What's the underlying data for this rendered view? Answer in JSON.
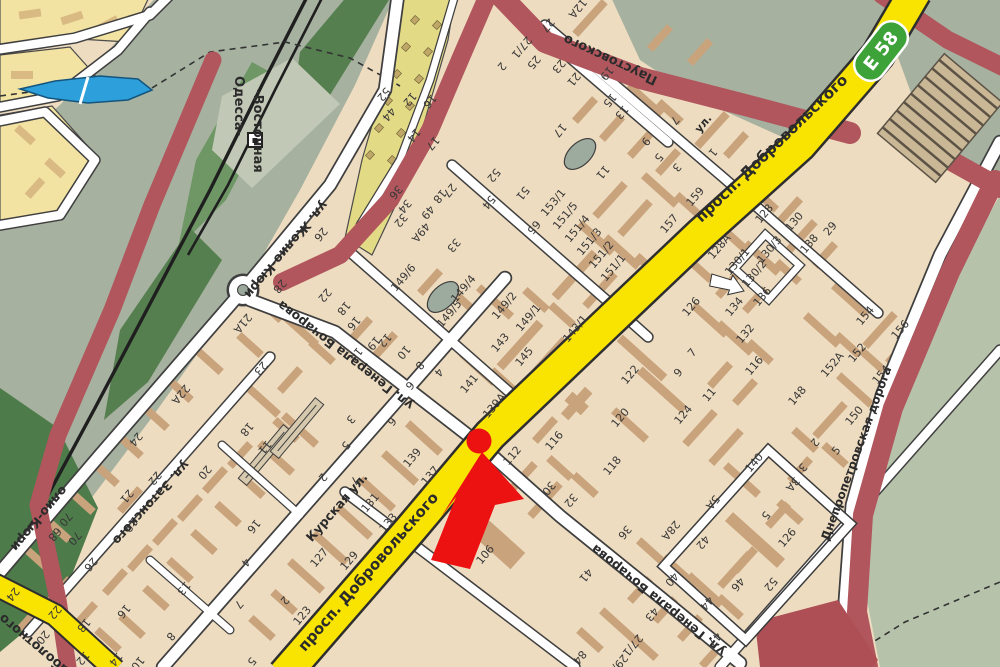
{
  "map": {
    "kind": "city-street-map",
    "highway_badge": {
      "code": "Е 58",
      "color": "#3da338"
    },
    "marker": {
      "shape": "red-arrow-with-dot",
      "color": "#ec1212"
    },
    "colors": {
      "block_fill": "#eedcc0",
      "building": "#c8a37c",
      "avenue": "#f9e300",
      "major_road": "#b0565c",
      "greenery": "#a6b1a0",
      "water": "#2d9fdb"
    },
    "street_labels": [
      {
        "t": "просп. Добровольского",
        "x": 775,
        "y": 152,
        "r": -44,
        "s": 15
      },
      {
        "t": "просп. Добровольского",
        "x": 372,
        "y": 575,
        "r": -49,
        "s": 15
      },
      {
        "t": "Курская ул.",
        "x": 340,
        "y": 510,
        "r": -49,
        "s": 12.5
      },
      {
        "t": "ул. Генерала Бочарова",
        "x": 348,
        "y": 352,
        "r": 218,
        "s": 12.5
      },
      {
        "t": "ул. Генерала Бочарова",
        "x": 661,
        "y": 597,
        "r": 219,
        "s": 12.5
      },
      {
        "t": "ул. Жолио-Кюри",
        "x": 283,
        "y": 247,
        "r": 130,
        "s": 12.5
      },
      {
        "t": "олио-Кюри",
        "x": 36,
        "y": 516,
        "r": 130,
        "s": 12.5
      },
      {
        "t": "ул. Затонского",
        "x": 148,
        "y": 500,
        "r": 132,
        "s": 12.5
      },
      {
        "t": "Паустовского",
        "x": 612,
        "y": 56,
        "r": 205,
        "s": 13
      },
      {
        "t": "Днепропетровская дорога",
        "x": 860,
        "y": 455,
        "r": -70,
        "s": 12
      },
      {
        "t": "Заболотного",
        "x": 40,
        "y": 644,
        "r": 220,
        "s": 13
      },
      {
        "t": "Одесса-",
        "x": 235,
        "y": 106,
        "r": 90,
        "s": 13
      },
      {
        "t": "-Восточная",
        "x": 254,
        "y": 131,
        "r": 90,
        "s": 13
      },
      {
        "t": "ул.",
        "x": 706,
        "y": 126,
        "r": -50,
        "s": 11
      }
    ],
    "number_labels": [
      {
        "t": "12A",
        "x": 575,
        "y": 6,
        "r": 130
      },
      {
        "t": "27",
        "x": 545,
        "y": 23,
        "r": 130
      },
      {
        "t": "27/1",
        "x": 519,
        "y": 45,
        "r": 130
      },
      {
        "t": "25",
        "x": 531,
        "y": 60,
        "r": 130
      },
      {
        "t": "23",
        "x": 556,
        "y": 64,
        "r": 130
      },
      {
        "t": "21",
        "x": 571,
        "y": 77,
        "r": 130
      },
      {
        "t": "19",
        "x": 604,
        "y": 71,
        "r": 130
      },
      {
        "t": "15",
        "x": 607,
        "y": 98,
        "r": 130
      },
      {
        "t": "13",
        "x": 619,
        "y": 110,
        "r": 130
      },
      {
        "t": "17",
        "x": 557,
        "y": 128,
        "r": 130
      },
      {
        "t": "9",
        "x": 643,
        "y": 139,
        "r": 130
      },
      {
        "t": "7",
        "x": 672,
        "y": 118,
        "r": 130
      },
      {
        "t": "11",
        "x": 600,
        "y": 170,
        "r": 130
      },
      {
        "t": "5",
        "x": 656,
        "y": 155,
        "r": 130
      },
      {
        "t": "3",
        "x": 674,
        "y": 165,
        "r": 130
      },
      {
        "t": "1",
        "x": 710,
        "y": 150,
        "r": 130
      },
      {
        "t": "153/1",
        "x": 556,
        "y": 205,
        "r": -50
      },
      {
        "t": "151/5",
        "x": 568,
        "y": 218,
        "r": -50
      },
      {
        "t": "151/4",
        "x": 580,
        "y": 231,
        "r": -50
      },
      {
        "t": "151/3",
        "x": 592,
        "y": 244,
        "r": -50
      },
      {
        "t": "151/2",
        "x": 604,
        "y": 257,
        "r": -50
      },
      {
        "t": "151/1",
        "x": 616,
        "y": 270,
        "r": -50
      },
      {
        "t": "157",
        "x": 672,
        "y": 226,
        "r": -50
      },
      {
        "t": "159",
        "x": 698,
        "y": 199,
        "r": -50
      },
      {
        "t": "149/6",
        "x": 406,
        "y": 280,
        "r": -50
      },
      {
        "t": "149/4",
        "x": 466,
        "y": 291,
        "r": -50
      },
      {
        "t": "149/5",
        "x": 452,
        "y": 316,
        "r": -50
      },
      {
        "t": "149/2",
        "x": 507,
        "y": 308,
        "r": -50
      },
      {
        "t": "149/1",
        "x": 531,
        "y": 320,
        "r": -50
      },
      {
        "t": "143",
        "x": 503,
        "y": 345,
        "r": -50
      },
      {
        "t": "145",
        "x": 527,
        "y": 359,
        "r": -50
      },
      {
        "t": "143/1",
        "x": 578,
        "y": 331,
        "r": -50
      },
      {
        "t": "141",
        "x": 472,
        "y": 386,
        "r": -50
      },
      {
        "t": "139A",
        "x": 497,
        "y": 408,
        "r": -50
      },
      {
        "t": "2",
        "x": 499,
        "y": 64,
        "r": 130
      },
      {
        "t": "52",
        "x": 381,
        "y": 92,
        "r": 130
      },
      {
        "t": "44",
        "x": 386,
        "y": 112,
        "r": 130
      },
      {
        "t": "12",
        "x": 407,
        "y": 97,
        "r": 130
      },
      {
        "t": "16",
        "x": 427,
        "y": 99,
        "r": 130
      },
      {
        "t": "14",
        "x": 411,
        "y": 133,
        "r": 130
      },
      {
        "t": "17",
        "x": 430,
        "y": 141,
        "r": 130
      },
      {
        "t": "27",
        "x": 447,
        "y": 188,
        "r": 130
      },
      {
        "t": "52",
        "x": 491,
        "y": 173,
        "r": 130
      },
      {
        "t": "54",
        "x": 486,
        "y": 200,
        "r": 130
      },
      {
        "t": "51",
        "x": 520,
        "y": 191,
        "r": 130
      },
      {
        "t": "65",
        "x": 531,
        "y": 225,
        "r": 130
      },
      {
        "t": "33",
        "x": 451,
        "y": 243,
        "r": 130
      },
      {
        "t": "18",
        "x": 437,
        "y": 194,
        "r": 130
      },
      {
        "t": "36",
        "x": 393,
        "y": 190,
        "r": 130
      },
      {
        "t": "34",
        "x": 402,
        "y": 204,
        "r": 130
      },
      {
        "t": "32",
        "x": 398,
        "y": 218,
        "r": 130
      },
      {
        "t": "49",
        "x": 425,
        "y": 210,
        "r": 130
      },
      {
        "t": "49A",
        "x": 418,
        "y": 230,
        "r": 130
      },
      {
        "t": "26",
        "x": 318,
        "y": 232,
        "r": 130
      },
      {
        "t": "28",
        "x": 277,
        "y": 284,
        "r": 130
      },
      {
        "t": "22",
        "x": 322,
        "y": 293,
        "r": 130
      },
      {
        "t": "18",
        "x": 341,
        "y": 306,
        "r": 130
      },
      {
        "t": "16",
        "x": 351,
        "y": 321,
        "r": 130
      },
      {
        "t": "12",
        "x": 382,
        "y": 338,
        "r": 130
      },
      {
        "t": "14",
        "x": 353,
        "y": 352,
        "r": 130
      },
      {
        "t": "10",
        "x": 401,
        "y": 350,
        "r": 130
      },
      {
        "t": "8",
        "x": 417,
        "y": 363,
        "r": 130
      },
      {
        "t": "6",
        "x": 407,
        "y": 383,
        "r": 130
      },
      {
        "t": "4",
        "x": 436,
        "y": 370,
        "r": 130
      },
      {
        "t": "2",
        "x": 320,
        "y": 475,
        "r": 130
      },
      {
        "t": "3",
        "x": 348,
        "y": 417,
        "r": 130
      },
      {
        "t": "5",
        "x": 343,
        "y": 443,
        "r": 130
      },
      {
        "t": "6",
        "x": 389,
        "y": 419,
        "r": 130
      },
      {
        "t": "7",
        "x": 352,
        "y": 478,
        "r": 130
      },
      {
        "t": "139",
        "x": 415,
        "y": 460,
        "r": -50
      },
      {
        "t": "137",
        "x": 433,
        "y": 478,
        "r": -50
      },
      {
        "t": "131",
        "x": 373,
        "y": 505,
        "r": -50
      },
      {
        "t": "133",
        "x": 391,
        "y": 525,
        "r": -50
      },
      {
        "t": "127",
        "x": 322,
        "y": 560,
        "r": -50
      },
      {
        "t": "129",
        "x": 352,
        "y": 563,
        "r": -50
      },
      {
        "t": "123",
        "x": 305,
        "y": 618,
        "r": -50
      },
      {
        "t": "112",
        "x": 515,
        "y": 458,
        "r": -50
      },
      {
        "t": "116",
        "x": 557,
        "y": 443,
        "r": -50
      },
      {
        "t": "106",
        "x": 488,
        "y": 557,
        "r": -50
      },
      {
        "t": "30",
        "x": 546,
        "y": 486,
        "r": 130
      },
      {
        "t": "32",
        "x": 568,
        "y": 498,
        "r": 130
      },
      {
        "t": "36",
        "x": 622,
        "y": 530,
        "r": 130
      },
      {
        "t": "28A",
        "x": 668,
        "y": 528,
        "r": 130
      },
      {
        "t": "122",
        "x": 633,
        "y": 377,
        "r": -50
      },
      {
        "t": "120",
        "x": 623,
        "y": 420,
        "r": -50
      },
      {
        "t": "124",
        "x": 686,
        "y": 417,
        "r": -50
      },
      {
        "t": "126",
        "x": 694,
        "y": 309,
        "r": -50
      },
      {
        "t": "118",
        "x": 615,
        "y": 468,
        "r": -50
      },
      {
        "t": "7",
        "x": 695,
        "y": 355,
        "r": -50
      },
      {
        "t": "9",
        "x": 681,
        "y": 375,
        "r": -50
      },
      {
        "t": "11",
        "x": 712,
        "y": 397,
        "r": -50
      },
      {
        "t": "116",
        "x": 757,
        "y": 368,
        "r": -50
      },
      {
        "t": "140",
        "x": 757,
        "y": 465,
        "r": -50
      },
      {
        "t": "126",
        "x": 790,
        "y": 540,
        "r": -50
      },
      {
        "t": "128",
        "x": 767,
        "y": 216,
        "r": -50
      },
      {
        "t": "128A",
        "x": 722,
        "y": 249,
        "r": -50
      },
      {
        "t": "130",
        "x": 797,
        "y": 224,
        "r": -50
      },
      {
        "t": "130/1",
        "x": 740,
        "y": 264,
        "r": -50
      },
      {
        "t": "130/2",
        "x": 757,
        "y": 276,
        "r": -50
      },
      {
        "t": "130/3",
        "x": 772,
        "y": 252,
        "r": -50
      },
      {
        "t": "138",
        "x": 812,
        "y": 246,
        "r": -50
      },
      {
        "t": "29",
        "x": 833,
        "y": 231,
        "r": -50
      },
      {
        "t": "134",
        "x": 737,
        "y": 309,
        "r": -50
      },
      {
        "t": "136",
        "x": 765,
        "y": 299,
        "r": -50
      },
      {
        "t": "132",
        "x": 748,
        "y": 336,
        "r": -50
      },
      {
        "t": "154",
        "x": 868,
        "y": 318,
        "r": -50
      },
      {
        "t": "156",
        "x": 903,
        "y": 332,
        "r": -50
      },
      {
        "t": "152",
        "x": 860,
        "y": 355,
        "r": -50
      },
      {
        "t": "152A",
        "x": 835,
        "y": 367,
        "r": -50
      },
      {
        "t": "154",
        "x": 884,
        "y": 377,
        "r": -50
      },
      {
        "t": "150",
        "x": 857,
        "y": 418,
        "r": -50
      },
      {
        "t": "148",
        "x": 800,
        "y": 398,
        "r": -50
      },
      {
        "t": "5",
        "x": 839,
        "y": 453,
        "r": -50
      },
      {
        "t": "41",
        "x": 583,
        "y": 573,
        "r": 130
      },
      {
        "t": "40",
        "x": 669,
        "y": 577,
        "r": 130
      },
      {
        "t": "42",
        "x": 700,
        "y": 540,
        "r": 130
      },
      {
        "t": "44",
        "x": 704,
        "y": 601,
        "r": 130
      },
      {
        "t": "46",
        "x": 735,
        "y": 582,
        "r": 130
      },
      {
        "t": "43",
        "x": 649,
        "y": 612,
        "r": 130
      },
      {
        "t": "47",
        "x": 712,
        "y": 637,
        "r": 130
      },
      {
        "t": "27/1",
        "x": 630,
        "y": 643,
        "r": 130
      },
      {
        "t": "29/2",
        "x": 615,
        "y": 663,
        "r": 130
      },
      {
        "t": "84",
        "x": 577,
        "y": 655,
        "r": 130
      },
      {
        "t": "52",
        "x": 768,
        "y": 582,
        "r": 130
      },
      {
        "t": "5A",
        "x": 710,
        "y": 500,
        "r": 130
      },
      {
        "t": "5",
        "x": 763,
        "y": 513,
        "r": 130
      },
      {
        "t": "3A",
        "x": 790,
        "y": 482,
        "r": 130
      },
      {
        "t": "2",
        "x": 812,
        "y": 440,
        "r": 130
      },
      {
        "t": "3",
        "x": 800,
        "y": 465,
        "r": 130
      },
      {
        "t": "21A",
        "x": 240,
        "y": 321,
        "r": 130
      },
      {
        "t": "23",
        "x": 258,
        "y": 366,
        "r": 130
      },
      {
        "t": "19",
        "x": 371,
        "y": 341,
        "r": 130
      },
      {
        "t": "22A",
        "x": 178,
        "y": 392,
        "r": 130
      },
      {
        "t": "24",
        "x": 133,
        "y": 437,
        "r": 130
      },
      {
        "t": "22",
        "x": 152,
        "y": 476,
        "r": 130
      },
      {
        "t": "21",
        "x": 124,
        "y": 494,
        "r": 130
      },
      {
        "t": "19",
        "x": 128,
        "y": 523,
        "r": 130
      },
      {
        "t": "20",
        "x": 202,
        "y": 470,
        "r": 130
      },
      {
        "t": "18",
        "x": 244,
        "y": 427,
        "r": 130
      },
      {
        "t": "11",
        "x": 262,
        "y": 445,
        "r": 130
      },
      {
        "t": "16",
        "x": 251,
        "y": 524,
        "r": 130
      },
      {
        "t": "4",
        "x": 243,
        "y": 560,
        "r": 130
      },
      {
        "t": "13",
        "x": 181,
        "y": 586,
        "r": 130
      },
      {
        "t": "7",
        "x": 236,
        "y": 602,
        "r": 130
      },
      {
        "t": "26",
        "x": 88,
        "y": 562,
        "r": 130
      },
      {
        "t": "70",
        "x": 63,
        "y": 517,
        "r": 130
      },
      {
        "t": "68",
        "x": 52,
        "y": 532,
        "r": 130
      },
      {
        "t": "70",
        "x": 72,
        "y": 536,
        "r": 130
      },
      {
        "t": "24",
        "x": 10,
        "y": 592,
        "r": 130
      },
      {
        "t": "22",
        "x": 52,
        "y": 610,
        "r": 130
      },
      {
        "t": "18",
        "x": 81,
        "y": 623,
        "r": 130
      },
      {
        "t": "20",
        "x": 40,
        "y": 635,
        "r": 130
      },
      {
        "t": "16",
        "x": 121,
        "y": 609,
        "r": 130
      },
      {
        "t": "12",
        "x": 80,
        "y": 656,
        "r": 130
      },
      {
        "t": "14",
        "x": 113,
        "y": 657,
        "r": 130
      },
      {
        "t": "10",
        "x": 135,
        "y": 661,
        "r": 130
      },
      {
        "t": "8",
        "x": 168,
        "y": 634,
        "r": 130
      },
      {
        "t": "5",
        "x": 249,
        "y": 659,
        "r": 130
      },
      {
        "t": "2",
        "x": 282,
        "y": 598,
        "r": 130
      }
    ]
  }
}
